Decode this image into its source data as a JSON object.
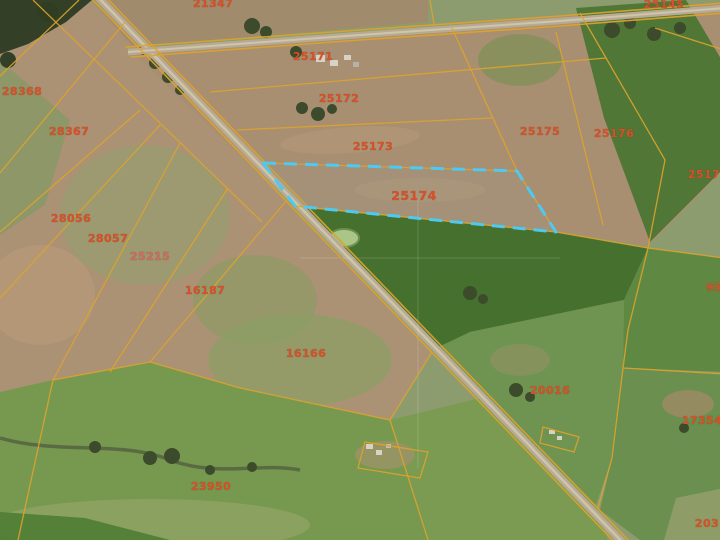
{
  "map": {
    "type": "cadastral-gis-satellite-view",
    "selected_parcel_id": "25174",
    "colors": {
      "parcel_boundary": "#dda32c",
      "selected_parcel_outline": "#4ec9f2",
      "parcel_label": "#d94f28",
      "parcel_label_muted": "#cf6b5e",
      "road_surface": "#b7aa92"
    },
    "parcel_labels": [
      {
        "id": "21347",
        "partially_visible": true
      },
      {
        "id": "25145",
        "partially_visible": true
      },
      {
        "id": "25171"
      },
      {
        "id": "25172"
      },
      {
        "id": "25173"
      },
      {
        "id": "25174",
        "selected": true
      },
      {
        "id": "25175"
      },
      {
        "id": "25176"
      },
      {
        "id": "25177",
        "partially_visible": true
      },
      {
        "id": "28368"
      },
      {
        "id": "28367"
      },
      {
        "id": "28056"
      },
      {
        "id": "28057"
      },
      {
        "id": "25215"
      },
      {
        "id": "16187"
      },
      {
        "id": "16166"
      },
      {
        "id": "20016"
      },
      {
        "id": "17354",
        "partially_visible": true
      },
      {
        "id": "95",
        "partially_visible": true
      },
      {
        "id": "23950"
      },
      {
        "id": "2031",
        "partially_visible": true
      }
    ]
  }
}
